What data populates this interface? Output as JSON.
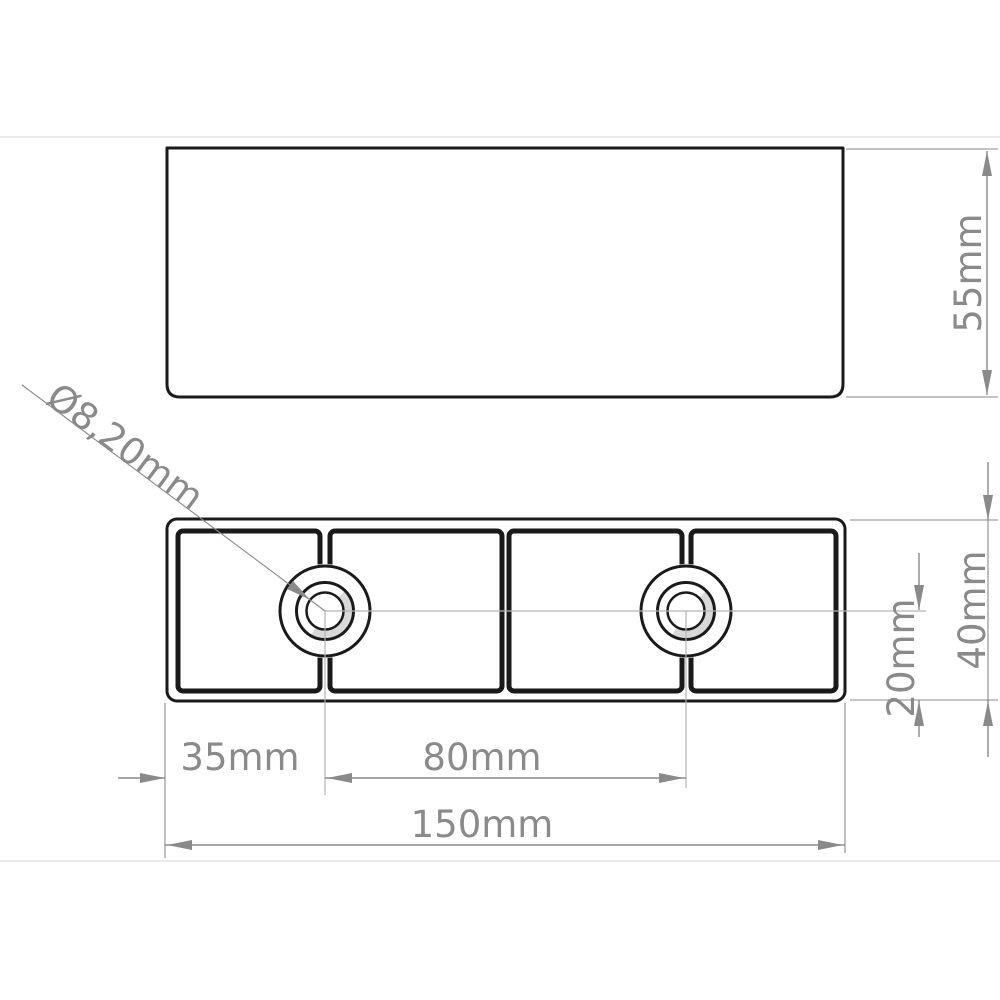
{
  "drawing": {
    "title": "furniture-foot technical drawing, two views",
    "views": {
      "side_view": "side profile",
      "bottom_view": "underside with screw bosses"
    },
    "labels": {
      "hole_diameter": "Ø8,20mm",
      "side_height": "55mm",
      "hole_edge_offset": "35mm",
      "hole_spacing": "80mm",
      "total_width": "150mm",
      "center_to_bottom": "20mm",
      "body_height": "40mm"
    },
    "colors": {
      "background": "#ffffff",
      "part_line": "#1a1a1a",
      "dimension_line": "#8a8a8a",
      "dimension_text": "#8a8a8a",
      "centerline": "#b3b3b3",
      "thread_shade": "#d9d9d9",
      "faint_divider": "#eaeaea"
    }
  }
}
